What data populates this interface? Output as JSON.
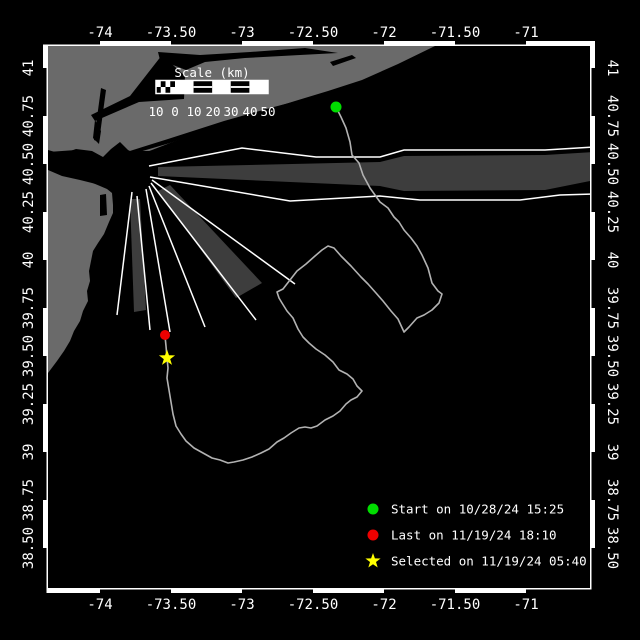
{
  "colors": {
    "background": "#000000",
    "water": "#000000",
    "land": "#6a6a6a",
    "lane_zone": "#3d3d3d",
    "lane_line": "#ffffff",
    "track": "#b2b2b2",
    "frame": "#ffffff",
    "text": "#ffffff",
    "start": "#00dd00",
    "last": "#ee0000",
    "selected": "#ffff00"
  },
  "axes": {
    "lon_ticks": [
      {
        "label": "-74",
        "x": 100
      },
      {
        "label": "-73.50",
        "x": 171
      },
      {
        "label": "-73",
        "x": 242
      },
      {
        "label": "-72.50",
        "x": 313
      },
      {
        "label": "-72",
        "x": 384
      },
      {
        "label": "-71.50",
        "x": 455
      },
      {
        "label": "-71",
        "x": 526
      }
    ],
    "lat_ticks": [
      {
        "label": "41",
        "y": 68
      },
      {
        "label": "40.75",
        "y": 116
      },
      {
        "label": "40.50",
        "y": 164
      },
      {
        "label": "40.25",
        "y": 212
      },
      {
        "label": "40",
        "y": 260
      },
      {
        "label": "39.75",
        "y": 308
      },
      {
        "label": "39.50",
        "y": 356
      },
      {
        "label": "39.25",
        "y": 404
      },
      {
        "label": "39",
        "y": 452
      },
      {
        "label": "38.75",
        "y": 500
      },
      {
        "label": "38.50",
        "y": 548
      }
    ]
  },
  "scale_bar": {
    "title": "Scale (km)",
    "tick_labels": [
      {
        "t": "10",
        "x": 156
      },
      {
        "t": "0",
        "x": 175
      },
      {
        "t": "10",
        "x": 194
      },
      {
        "t": "20",
        "x": 213
      },
      {
        "t": "30",
        "x": 231
      },
      {
        "t": "40",
        "x": 250
      },
      {
        "t": "50",
        "x": 268
      }
    ]
  },
  "legend": {
    "items": [
      {
        "marker": "circle",
        "color_key": "start",
        "label": "Start on 10/28/24 15:25"
      },
      {
        "marker": "circle",
        "color_key": "last",
        "label": "Last on 11/19/24 18:10"
      },
      {
        "marker": "star",
        "color_key": "selected",
        "label": "Selected on 11/19/24 05:40"
      }
    ]
  },
  "markers": {
    "start": {
      "x": 336,
      "y": 107
    },
    "last": {
      "x": 165,
      "y": 335
    },
    "selected": {
      "x": 167,
      "y": 358
    }
  },
  "track_points": [
    [
      336,
      107
    ],
    [
      341,
      117
    ],
    [
      346,
      128
    ],
    [
      350,
      142
    ],
    [
      352,
      155
    ],
    [
      359,
      163
    ],
    [
      363,
      175
    ],
    [
      370,
      188
    ],
    [
      380,
      202
    ],
    [
      388,
      208
    ],
    [
      394,
      217
    ],
    [
      399,
      222
    ],
    [
      404,
      230
    ],
    [
      411,
      238
    ],
    [
      417,
      246
    ],
    [
      422,
      255
    ],
    [
      428,
      268
    ],
    [
      432,
      283
    ],
    [
      438,
      291
    ],
    [
      442,
      294
    ],
    [
      439,
      303
    ],
    [
      432,
      310
    ],
    [
      424,
      315
    ],
    [
      417,
      318
    ],
    [
      409,
      327
    ],
    [
      404,
      332
    ],
    [
      398,
      319
    ],
    [
      391,
      311
    ],
    [
      383,
      301
    ],
    [
      376,
      293
    ],
    [
      368,
      284
    ],
    [
      361,
      277
    ],
    [
      351,
      266
    ],
    [
      341,
      256
    ],
    [
      334,
      248
    ],
    [
      328,
      246
    ],
    [
      322,
      250
    ],
    [
      315,
      256
    ],
    [
      306,
      264
    ],
    [
      297,
      271
    ],
    [
      290,
      280
    ],
    [
      283,
      289
    ],
    [
      277,
      292
    ],
    [
      279,
      298
    ],
    [
      282,
      303
    ],
    [
      287,
      311
    ],
    [
      293,
      318
    ],
    [
      298,
      329
    ],
    [
      303,
      337
    ],
    [
      309,
      343
    ],
    [
      316,
      349
    ],
    [
      325,
      355
    ],
    [
      333,
      362
    ],
    [
      339,
      370
    ],
    [
      347,
      374
    ],
    [
      353,
      379
    ],
    [
      357,
      386
    ],
    [
      362,
      391
    ],
    [
      357,
      397
    ],
    [
      351,
      400
    ],
    [
      346,
      404
    ],
    [
      340,
      411
    ],
    [
      333,
      416
    ],
    [
      325,
      420
    ],
    [
      317,
      426
    ],
    [
      311,
      428
    ],
    [
      305,
      427
    ],
    [
      299,
      428
    ],
    [
      291,
      433
    ],
    [
      284,
      438
    ],
    [
      277,
      442
    ],
    [
      269,
      449
    ],
    [
      261,
      453
    ],
    [
      252,
      457
    ],
    [
      243,
      460
    ],
    [
      234,
      462
    ],
    [
      228,
      463
    ],
    [
      220,
      460
    ],
    [
      212,
      458
    ],
    [
      203,
      453
    ],
    [
      194,
      448
    ],
    [
      186,
      441
    ],
    [
      181,
      434
    ],
    [
      176,
      426
    ],
    [
      173,
      414
    ],
    [
      171,
      402
    ],
    [
      169,
      390
    ],
    [
      167,
      378
    ],
    [
      168,
      368
    ],
    [
      167,
      358
    ],
    [
      166,
      346
    ],
    [
      165,
      336
    ]
  ],
  "geography": {
    "land": [
      "M48,46 L435,46 L398,64 L362,80 L328,91 L295,101 L260,112 L228,123 L198,133 L170,143 L152,150 L138,155 L128,150 L120,142 L111,149 L103,157 L92,151 L76,149 L62,154 L48,150 Z",
      "M48,158 L58,162 L64,168 L72,176 L88,181 L100,186 L107,189 L112,193 L113,205 L113,213 L109,222 L104,234 L98,243 L93,251 L91,261 L89,271 L90,281 L87,291 L88,301 L83,311 L80,321 L74,331 L70,341 L64,351 L57,361 L51,369 L48,373 Z"
    ],
    "water_features": [
      "M158,52 L200,55 L250,52 L305,48 L338,53 L300,55 L245,58 L205,62 L186,70 L160,60 Z",
      "M162,55 L185,76 L184,99 L139,102 L95,121 L91,115 L130,96 Z",
      "M95,120 L101,131 L99,144 L93,138 Z",
      "M101,88 L106,90 L99,142 L94,140 Z",
      "M48,152 L76,150 L92,152 L103,158 L112,150 L120,143 L128,151 L150,151 L143,160 L128,166 L113,176 L104,183 L96,184 L80,180 L62,176 L48,170 Z",
      "M100,195 L106,194 L107,215 L100,216 Z",
      "M120,154 L168,139 L224,121 L270,108 L308,98 L309,101 L272,111 L226,125 L170,143 L122,157 Z",
      "M330,62 L352,55 L356,58 L333,66 Z"
    ]
  },
  "lanes": {
    "zones": [
      "M158,167 L380,162 L404,156 L545,155 L595,152 L595,180 L545,190 L404,191 L380,186 L158,176 Z",
      "M158,191 L170,185 L262,283 L236,298 Z",
      "M130,199 L140,199 L146,310 L134,312 Z"
    ],
    "lines": [
      "M149,166 L242,148 L316,157 L380,157 L404,150 L545,150 L595,147",
      "M150,177 L290,201 L380,196 L420,200 L520,200 L560,195 L595,194",
      "M152,180 L295,284",
      "M151,183 L256,320",
      "M149,186 L205,327",
      "M146,189 L170,332",
      "M132,192 L117,315",
      "M137,196 L150,330"
    ]
  }
}
